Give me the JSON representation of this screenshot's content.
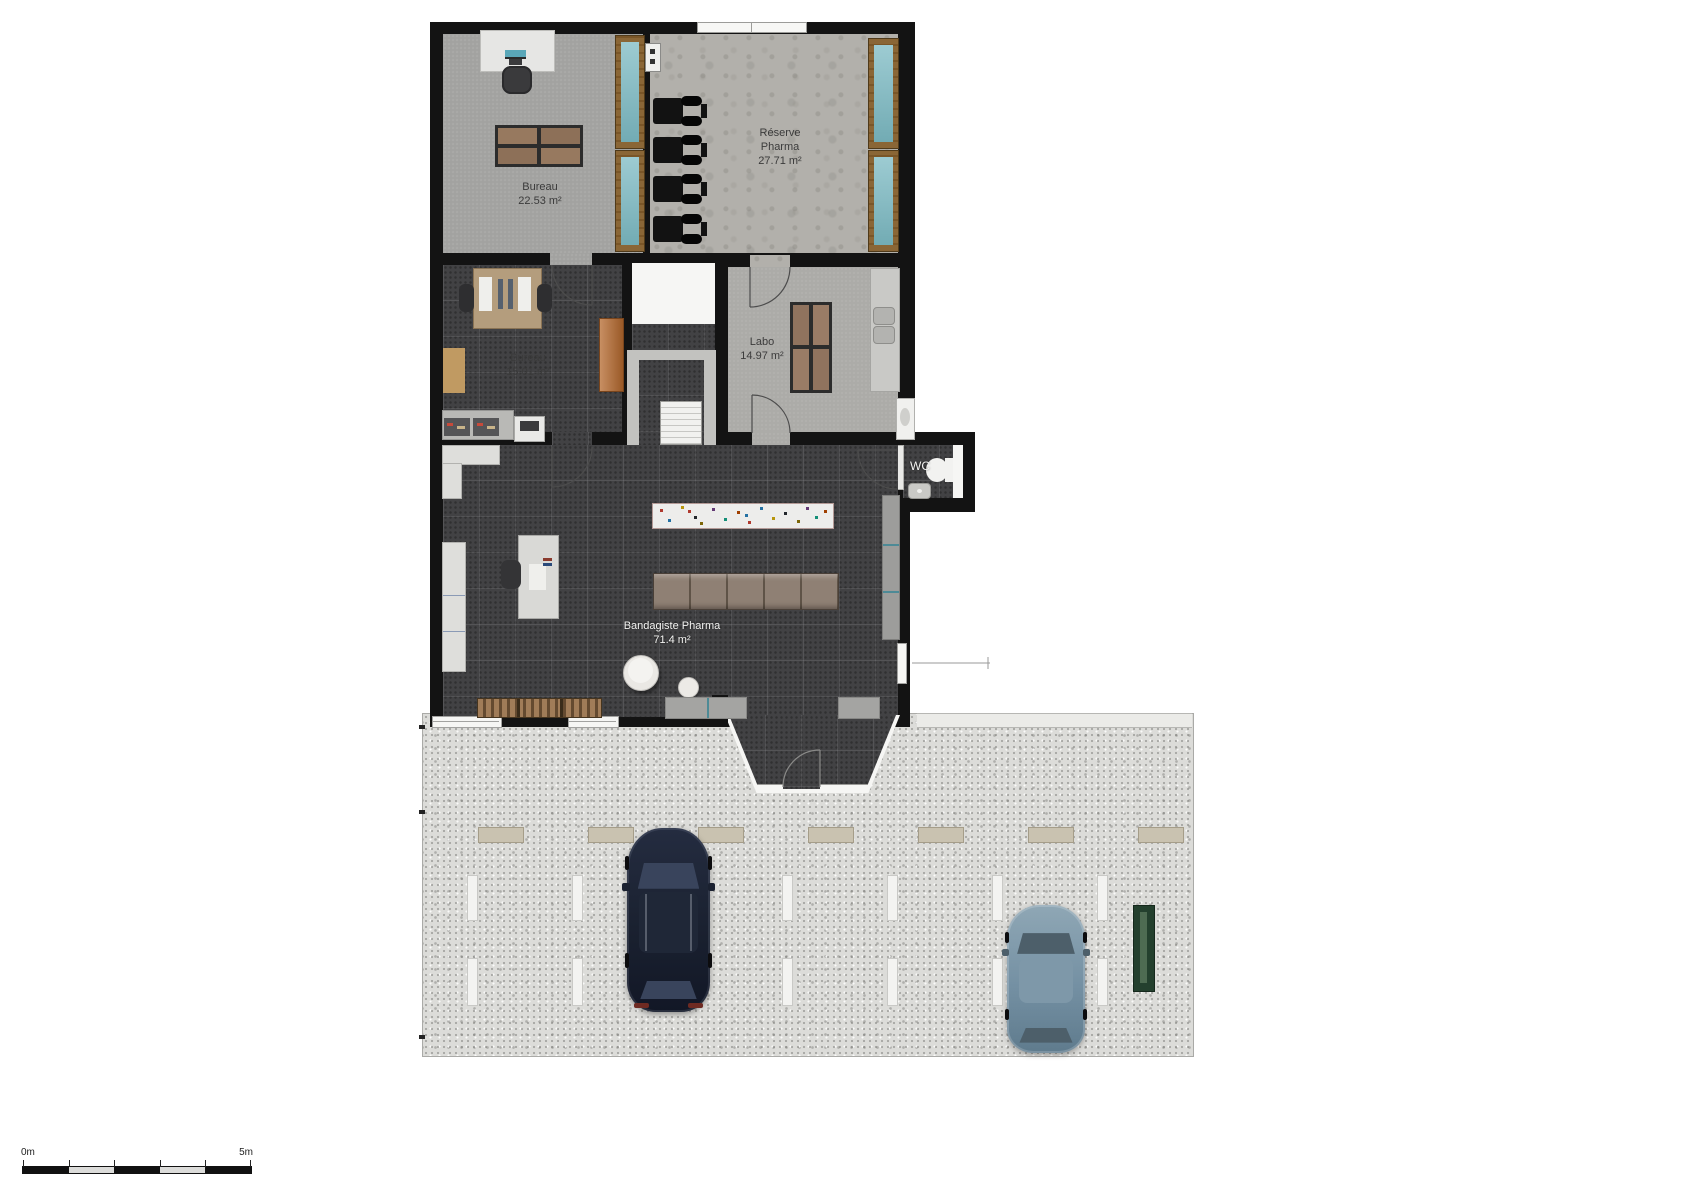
{
  "rooms": {
    "bureau_top": {
      "name": "Bureau",
      "area": "22.53 m²"
    },
    "reserve": {
      "line1": "Réserve",
      "line2": "Pharma",
      "area": "27.71 m²",
      "wheelchair_count": 4,
      "shelf_unit_count": 4
    },
    "bureau_mid": {
      "name": "Bureau",
      "area": "15.01 m²"
    },
    "labo": {
      "name": "Labo",
      "area": "14.97 m²"
    },
    "wc": {
      "label": "WC"
    },
    "shop": {
      "name": "Bandagiste Pharma",
      "area": "71.4 m²"
    }
  },
  "scale_bar": {
    "start_label": "0m",
    "end_label": "5m",
    "segment_count": 5
  },
  "parking": {
    "speed_bump_count": 7,
    "stall_marker_rows": 2,
    "stall_markers_per_row": 7,
    "car_count": 2
  },
  "cars": [
    {
      "name": "dark-navy-car",
      "body_color": "#1d2434"
    },
    {
      "name": "steel-blue-car",
      "body_color": "#7d98aa"
    }
  ],
  "colors": {
    "wall": "#131313",
    "dark_tile_floor": "#424244",
    "concrete_floor": "#b2b0ab",
    "light_floor": "#a2a2a0",
    "parking_surface": "#dcdcd9",
    "shelf_teal": "#7cbac3",
    "shelf_wood": "#8a6636",
    "cabinet_orange": "#b5692e",
    "bench_wood": "#a07c58",
    "speed_bump": "#c9c2b0",
    "planter_green": "#24402e"
  }
}
